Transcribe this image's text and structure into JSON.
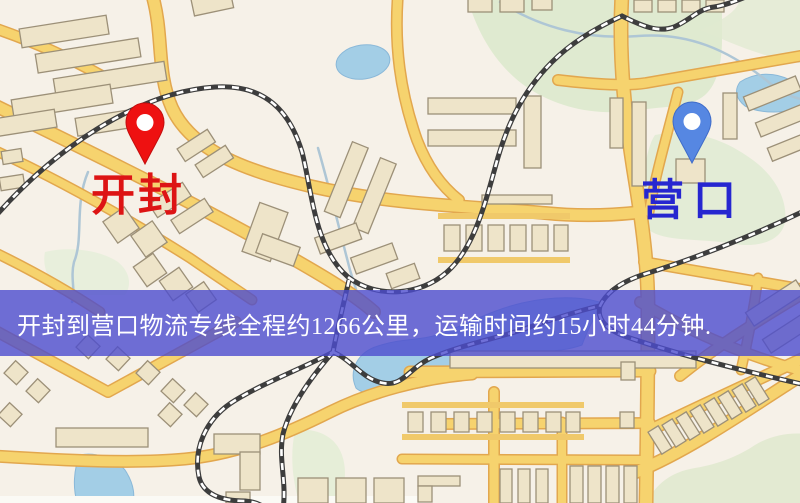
{
  "map": {
    "markers": [
      {
        "id": "origin",
        "label": "开封",
        "label_color": "#dd1414",
        "pin_color": "#ee1111",
        "pin_stroke": "#c40d0d"
      },
      {
        "id": "destination",
        "label": "营口",
        "label_color": "#2626d0",
        "pin_color": "#5687e2",
        "pin_stroke": "#3f6cc9"
      }
    ],
    "style_colors": {
      "background": "#f6f1e8",
      "road_fill": "#f6d36e",
      "road_casing": "#e2a74e",
      "building_fill": "#eee4c9",
      "building_stroke": "#9c9078",
      "green_area": "#dfead0",
      "water": "#a3cee6",
      "railway_dark": "#3d3d3d"
    }
  },
  "banner": {
    "text": "开封到营口物流专线全程约1266公里，运输时间约15小时44分钟.",
    "background": "rgba(76,76,206,0.80)",
    "text_color": "#ffffff"
  }
}
